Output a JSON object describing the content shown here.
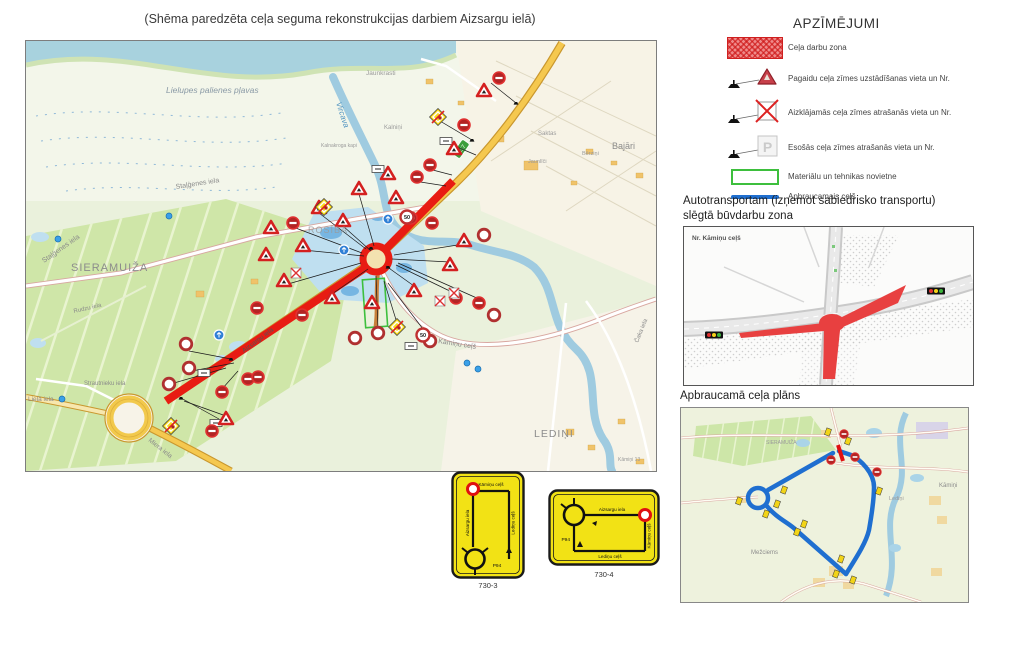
{
  "title": "(Shēma paredzēta ceļa seguma rekonstrukcijas darbiem Aizsargu ielā)",
  "legend": {
    "title": "APZĪMĒJUMI",
    "p_glyph": "P",
    "items": [
      {
        "name": "work-zone",
        "label": "Ceļa darbu zona"
      },
      {
        "name": "temp-sign",
        "label": "Pagaidu ceļa zīmes uzstādīšanas vieta un Nr."
      },
      {
        "name": "covered-sign",
        "label": "Aizklājamās ceļa zīmes atrašanās vieta un Nr."
      },
      {
        "name": "existing-sign",
        "label": "Esošās ceļa zīmes atrašanās vieta un Nr."
      },
      {
        "name": "materials-area",
        "label": "Materiālu un tehnikas novietne"
      },
      {
        "name": "detour-route",
        "label": "Apbraucamais ceļš"
      }
    ]
  },
  "closed_zone": {
    "heading_line1": "Autotransportam (izņemot sabiedrisko transportu)",
    "heading_line2": "slēgtā būvdarbu zona",
    "map_corner_label": "Nr. Kāmiņu ceļš"
  },
  "detour_plan": {
    "heading": "Apbraucamā ceļa plāns",
    "labels": {
      "kamini": "Kāmiņi",
      "mezciems": "Mežciems",
      "ledini": "Lediņi",
      "sieramuiza": "SIERAMUIŽA"
    }
  },
  "detour_signs": {
    "sign1": {
      "code": "730-3",
      "street_top": "Kāmiņu ceļš",
      "street_left": "Aizsargu iela",
      "street_right": "Lediņu ceļš",
      "road_ref": "P94"
    },
    "sign2": {
      "code": "730-4",
      "street_top": "Aizsargu iela",
      "street_right": "Kāmiņu ceļš",
      "street_bottom": "Lediņu ceļš",
      "road_ref": "P94"
    }
  },
  "main_map": {
    "road_badge": "C17",
    "speed_limit": "50",
    "labels": {
      "lielupes_plavas": "Lielupes palienes pļavas",
      "vircava": "Vircava",
      "stalgenes_iela": "Staļģenes iela",
      "sieramuiza": "SIERAMUIŽA",
      "rosiba": "ROSĪBA",
      "rudzu_iela": "Rudzu iela",
      "strautnieku_iela": "Strautnieku iela",
      "liela_iela": "Lielā iela",
      "miera_iela": "Miera iela",
      "aizsargu_iela": "Aizsargu iela",
      "kaminu_cels": "Kāmiņu ceļš",
      "ledini": "LEDIŅI",
      "caka_iela": "Čaka iela",
      "jaunkrasti": "Jaunkrasti",
      "kalnini": "Kalniņi",
      "saktas": "Saktas",
      "bajari": "Bajāri",
      "berzini": "Bērziņi",
      "jaunlici": "Jaunlīči",
      "kalnakroga_kapi": "Kalnakroga kapi",
      "kamini13": "Kāmiņi 13"
    }
  },
  "colors": {
    "work_zone": "#e81c13",
    "detour_route": "#1f6fd0",
    "materials_outline": "#3dbf3d",
    "priority_sign_yellow": "#f7d91c",
    "closed_fill": "#e84040"
  }
}
